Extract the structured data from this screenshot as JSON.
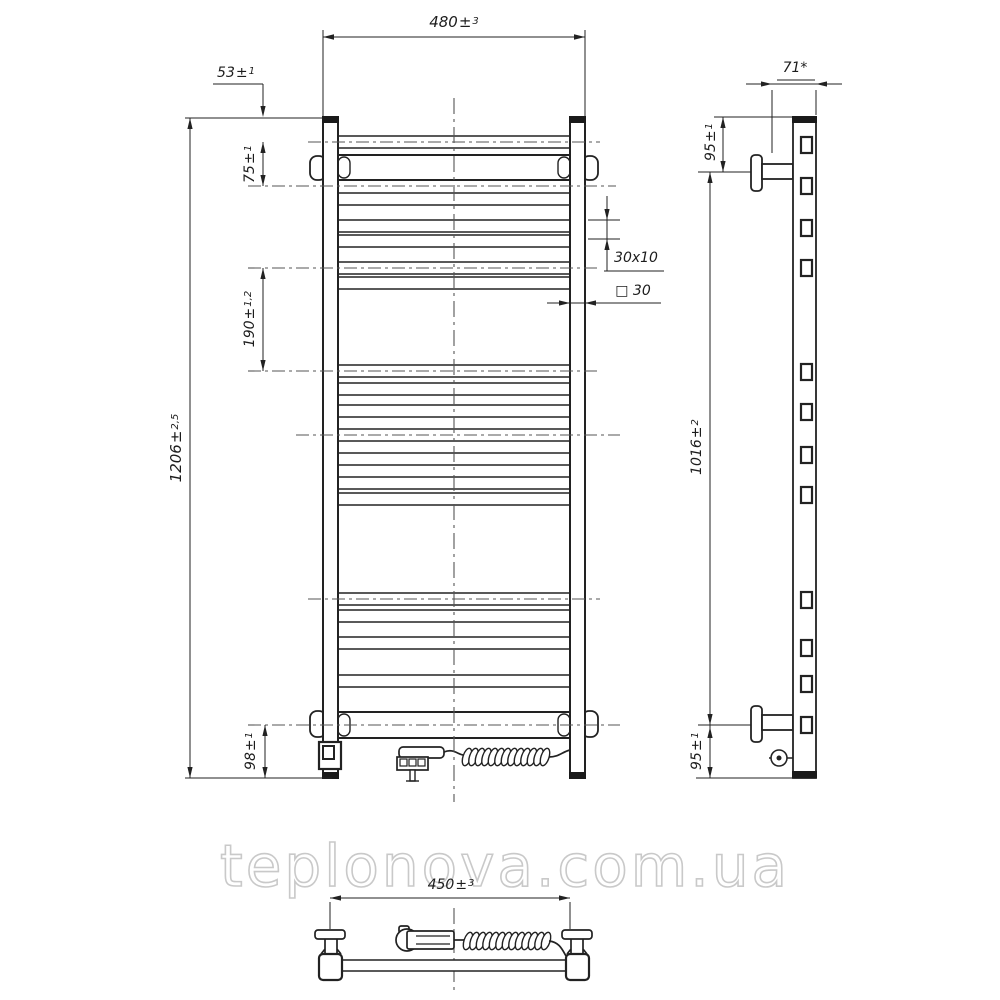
{
  "watermark": {
    "text": "teplonova.com.ua"
  },
  "symbols": {
    "pm": "±"
  },
  "views": {
    "front": {
      "dims": {
        "overall_width": {
          "value": "480",
          "tol": "3"
        },
        "top_to_first_rung": {
          "value": "53",
          "tol": "1"
        },
        "first_rung_to_bracket": {
          "value": "75",
          "tol": "1"
        },
        "rung_group_spacing": {
          "value": "190",
          "tol": "1,2"
        },
        "overall_height": {
          "value": "1206",
          "tol": "2,5"
        },
        "bracket_to_bottom": {
          "value": "98",
          "tol": "1"
        },
        "rung_profile": "30x10",
        "rail_profile": "□ 30"
      }
    },
    "side": {
      "dims": {
        "depth": "71*",
        "top_to_bracket": {
          "value": "95",
          "tol": "1"
        },
        "bracket_spacing": {
          "value": "1016",
          "tol": "2"
        },
        "bracket_to_bottom": {
          "value": "95",
          "tol": "1"
        }
      }
    },
    "bottom": {
      "dims": {
        "bracket_width": {
          "value": "450",
          "tol": "3"
        }
      }
    }
  }
}
